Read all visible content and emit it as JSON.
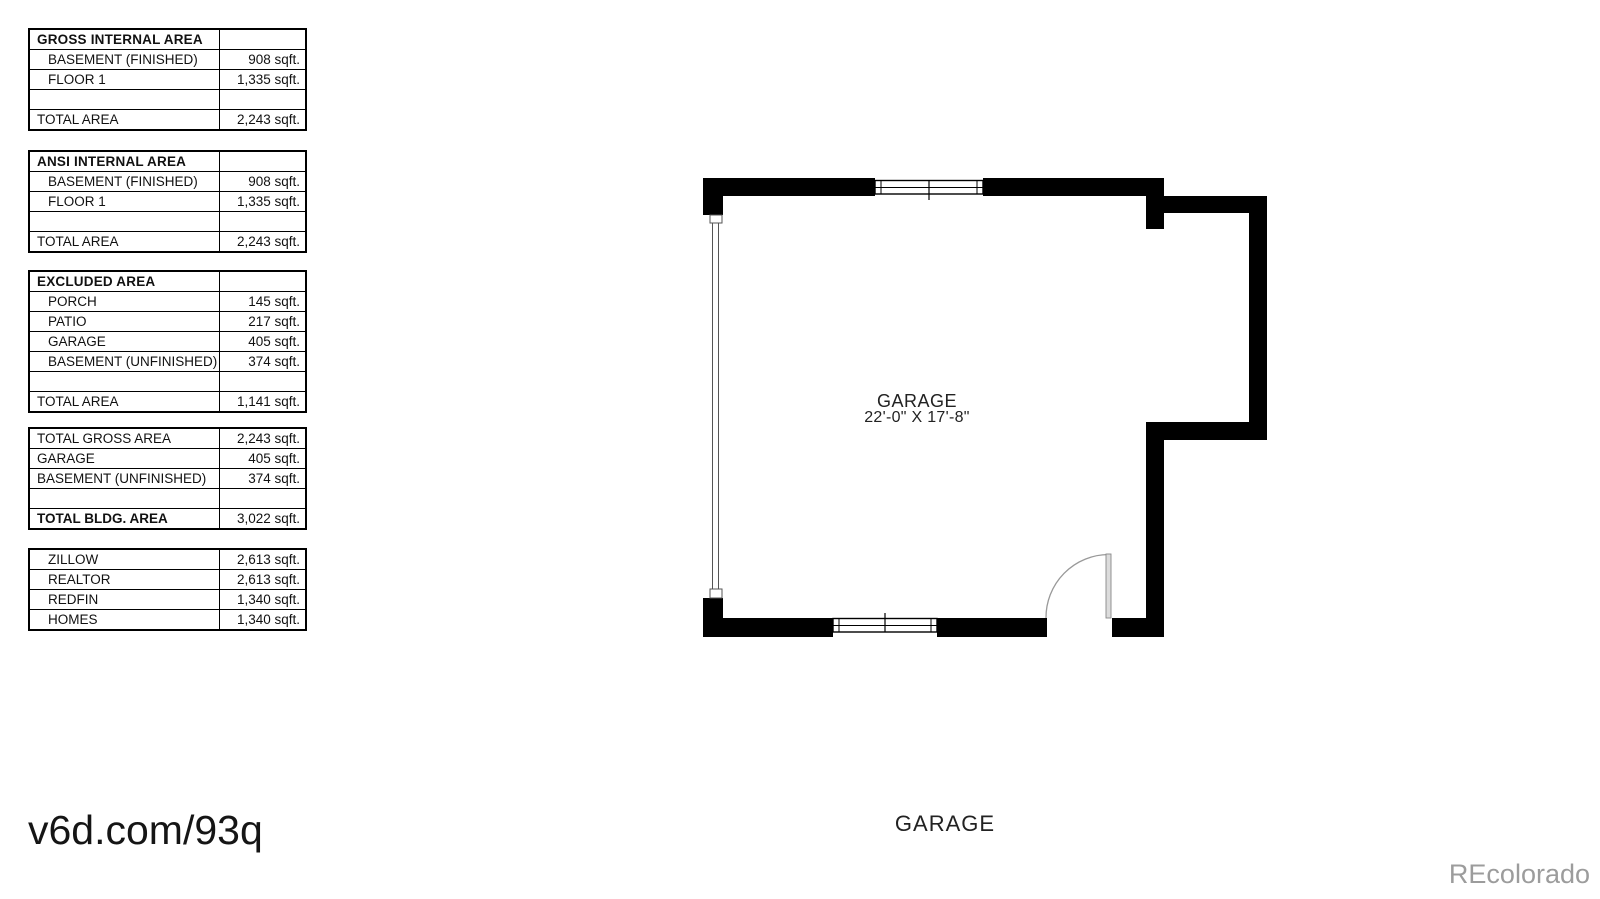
{
  "colors": {
    "wall": "#000000",
    "brand_gray": "#9c9c9c"
  },
  "area_tables": [
    {
      "rows": [
        {
          "label": "GROSS INTERNAL AREA",
          "value": ""
        },
        {
          "label": "BASEMENT (FINISHED)",
          "value": "908 sqft."
        },
        {
          "label": "FLOOR 1",
          "value": "1,335 sqft."
        },
        {
          "label": "",
          "value": ""
        },
        {
          "label": "TOTAL AREA",
          "value": "2,243 sqft."
        }
      ]
    },
    {
      "rows": [
        {
          "label": "ANSI INTERNAL AREA",
          "value": ""
        },
        {
          "label": "BASEMENT (FINISHED)",
          "value": "908 sqft."
        },
        {
          "label": "FLOOR 1",
          "value": "1,335 sqft."
        },
        {
          "label": "",
          "value": ""
        },
        {
          "label": "TOTAL AREA",
          "value": "2,243 sqft."
        }
      ]
    },
    {
      "rows": [
        {
          "label": "EXCLUDED AREA",
          "value": ""
        },
        {
          "label": "PORCH",
          "value": "145 sqft."
        },
        {
          "label": "PATIO",
          "value": "217 sqft."
        },
        {
          "label": "GARAGE",
          "value": "405 sqft."
        },
        {
          "label": "BASEMENT (UNFINISHED)",
          "value": "374 sqft."
        },
        {
          "label": "",
          "value": ""
        },
        {
          "label": "TOTAL AREA",
          "value": "1,141 sqft."
        }
      ]
    },
    {
      "rows": [
        {
          "label": "TOTAL GROSS AREA",
          "value": "2,243 sqft."
        },
        {
          "label": "GARAGE",
          "value": "405 sqft."
        },
        {
          "label": "BASEMENT (UNFINISHED)",
          "value": "374 sqft."
        },
        {
          "label": "",
          "value": ""
        },
        {
          "label": "TOTAL BLDG. AREA",
          "value": "3,022 sqft."
        }
      ]
    },
    {
      "rows": [
        {
          "label": "ZILLOW",
          "value": "2,613 sqft."
        },
        {
          "label": "REALTOR",
          "value": "2,613 sqft."
        },
        {
          "label": "REDFIN",
          "value": "1,340 sqft."
        },
        {
          "label": "HOMES",
          "value": "1,340 sqft."
        }
      ]
    }
  ],
  "floor_plan": {
    "room_label": "GARAGE",
    "room_dimensions": "22'-0\" X 17'-8\""
  },
  "footer": {
    "watermark_url": "v6d.com/93q",
    "plan_title": "GARAGE",
    "brand": "REcolorado"
  }
}
